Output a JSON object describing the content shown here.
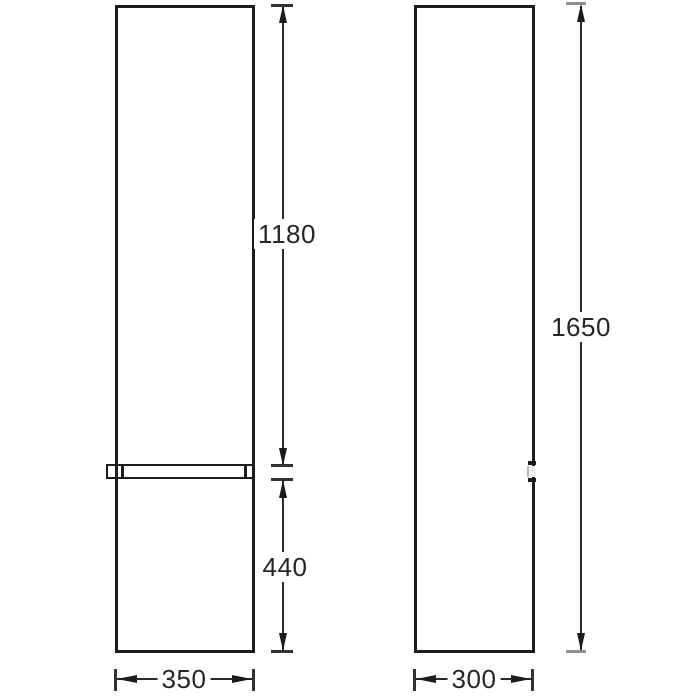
{
  "drawing": {
    "type": "technical-dimension-drawing",
    "front_view": {
      "upper_door_height": "1180",
      "lower_door_height": "440",
      "width": "350"
    },
    "side_view": {
      "total_height": "1650",
      "depth": "300"
    },
    "colors": {
      "line": "#1c1c1c",
      "gray_tick": "#8d8d8d",
      "background": "#ffffff",
      "text": "#262626"
    }
  }
}
